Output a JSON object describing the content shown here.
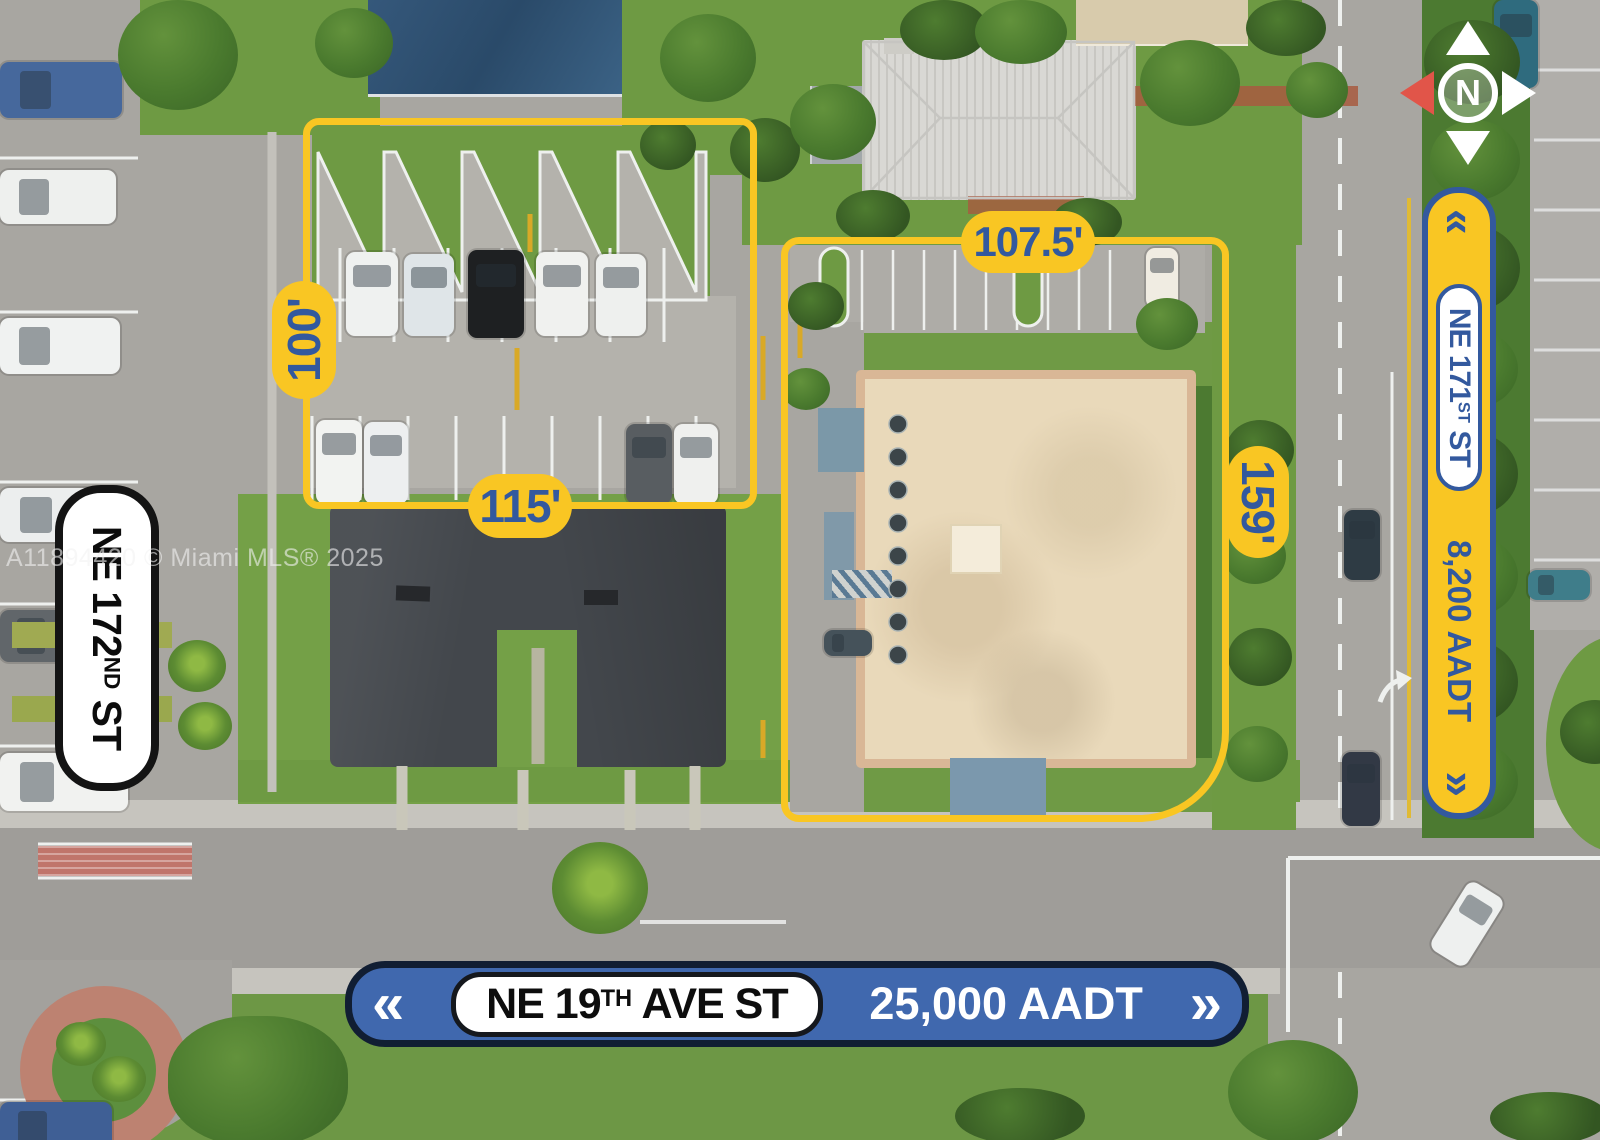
{
  "watermark": "A11894420 © Miami MLS® 2025",
  "compass": {
    "north": "N"
  },
  "icons": {
    "chevrons_left": "«",
    "chevrons_right": "»"
  },
  "parcels": {
    "parcel_1": {
      "height": "100'",
      "width": "115'"
    },
    "parcel_2": {
      "width": "107.5'",
      "height": "159'"
    }
  },
  "signs": {
    "ne_172nd_st": {
      "prefix": "NE 172",
      "ordinal": "ND",
      "suffix": " ST"
    },
    "ne_171st_st": {
      "prefix": "NE 171",
      "ordinal": "ST",
      "suffix": " ST",
      "aadt": "8,200 AADT"
    },
    "ne_19th_ave": {
      "prefix": "NE 19",
      "ordinal": "TH",
      "suffix": " AVE ST",
      "aadt": "25,000 AADT"
    }
  },
  "colors": {
    "annotation_yellow": "#F9C623",
    "annotation_blue": "#33599E",
    "sign_blue_bg": "#4068AE",
    "sign_navy_border": "#111E33",
    "compass_red": "#E15549"
  }
}
